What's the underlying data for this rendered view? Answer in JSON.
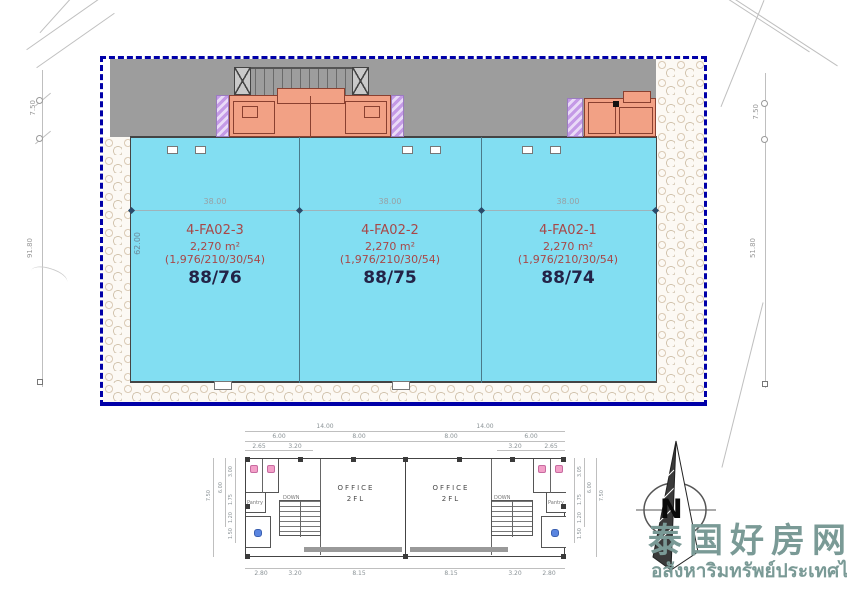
{
  "site_plan": {
    "border_color": "#0000a8",
    "floor_color": "#82def2",
    "road_band_color": "#9d9d9d",
    "office_color": "#f2a185",
    "column_hatch_color": "#c9a3e8",
    "dim_width_label": "38.00",
    "dim_interior_depth": "62.00",
    "left_dims": {
      "offset": "7.50",
      "depth": "91.80"
    },
    "right_dims": {
      "offset": "7.50",
      "depth": "51.80"
    },
    "units": [
      {
        "id": "4-FA02-3",
        "area": "2,270 m²",
        "breakdown": "(1,976/210/30/54)",
        "house_no": "88/76"
      },
      {
        "id": "4-FA02-2",
        "area": "2,270 m²",
        "breakdown": "(1,976/210/30/54)",
        "house_no": "88/75"
      },
      {
        "id": "4-FA02-1",
        "area": "2,270 m²",
        "breakdown": "(1,976/210/30/54)",
        "house_no": "88/74"
      }
    ]
  },
  "floor_plan": {
    "office_line1": "OFFICE",
    "office_line2": "2FL",
    "pantry_label": "Pantry",
    "down_label": "DOWN",
    "dims": {
      "top": [
        "14.00",
        "14.00"
      ],
      "row2": [
        "6.00",
        "8.00",
        "8.00",
        "6.00"
      ],
      "row3": [
        "2.65",
        "3.20",
        "3.20",
        "2.65"
      ],
      "bottom": [
        "2.80",
        "3.20",
        "8.15",
        "8.15",
        "3.20",
        "2.80"
      ],
      "left": [
        "7.50",
        "6.00",
        "3.00",
        "1.75",
        "1.20",
        "1.50"
      ],
      "right": [
        "3.05",
        "6.00",
        "7.50",
        "1.75",
        "1.20",
        "1.50"
      ]
    }
  },
  "logo": {
    "compass_letter": "N",
    "title_cn": "泰国好房网",
    "subtitle_th": "อสังหาริมทรัพย์ประเทศไทย",
    "text_color": "#7a9a96"
  }
}
